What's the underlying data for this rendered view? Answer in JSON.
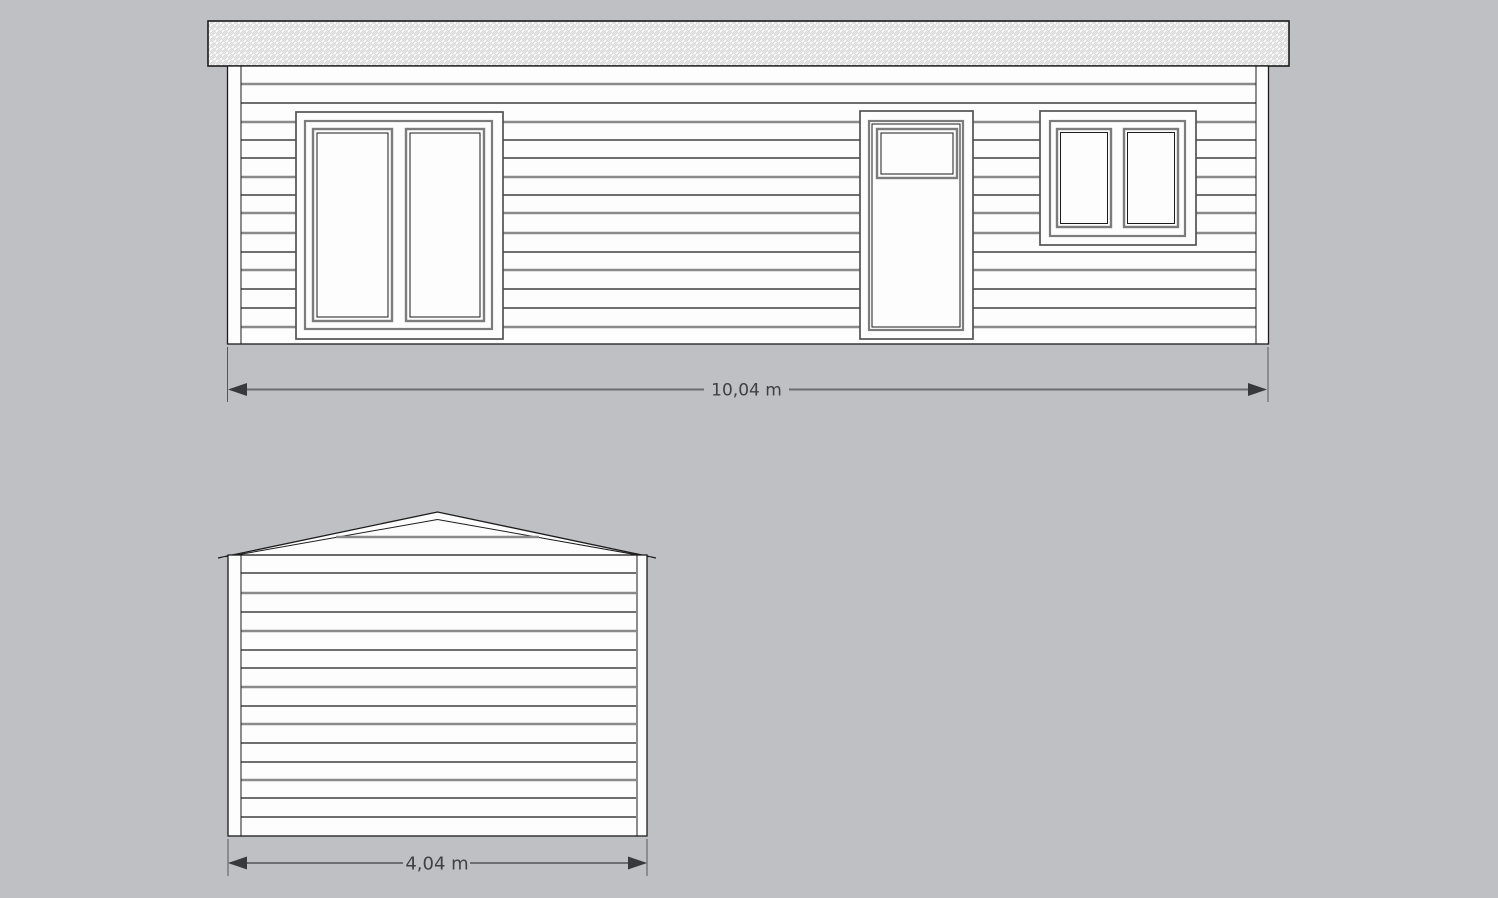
{
  "canvas": {
    "background_color": "#bfc0c4",
    "width_px": 1498,
    "height_px": 898
  },
  "colors": {
    "outline_black": "#1c1c1c",
    "siding_gray": "#8a8a8a",
    "window_frame_gray": "#7c7c7c",
    "dimension_dark_gray": "#3e4044",
    "wall_fill_white": "#fdfdfd",
    "roof_hatch_gray": "#d6d6d6"
  },
  "front_elevation": {
    "dimension_label": "10,04 m"
  },
  "gable_elevation": {
    "dimension_label": "4,04 m"
  }
}
